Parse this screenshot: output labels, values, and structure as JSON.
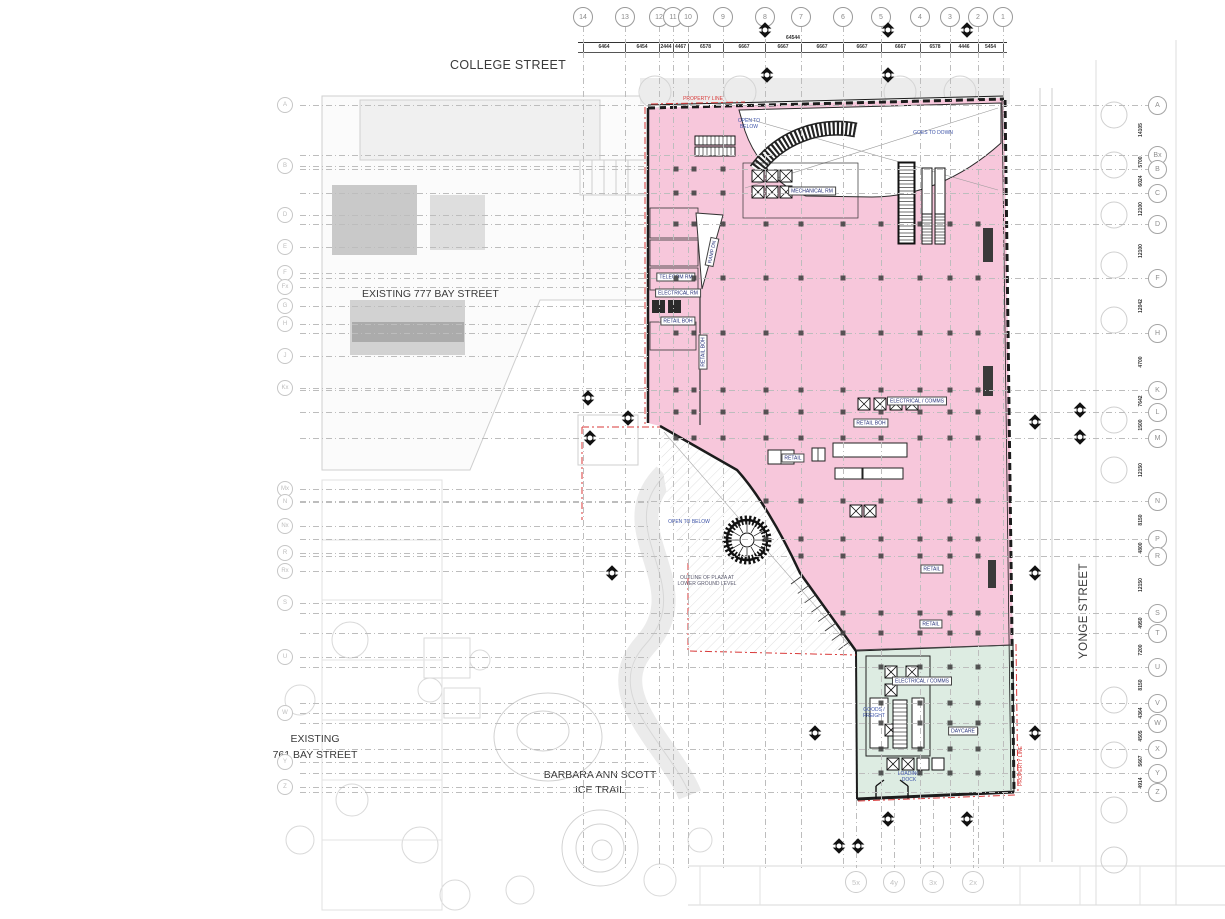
{
  "streets": {
    "college": "COLLEGE STREET",
    "yonge": "YONGE STREET",
    "bay777": "EXISTING 777 BAY STREET",
    "bay761": "EXISTING\n761 BAY STREET",
    "ice_trail": "BARBARA ANN SCOTT\nICE TRAIL"
  },
  "colors": {
    "retail_fill": "#f7c7db",
    "daycare_fill": "#ddece2",
    "property_line": "#d93a3a",
    "note_blue": "#3d53a8",
    "grid_line": "#bdbdbd",
    "wall": "#1c1c1c",
    "underlay": "#d2d2d2"
  },
  "grid": {
    "top": [
      {
        "label": "14",
        "x": 583
      },
      {
        "label": "13",
        "x": 625
      },
      {
        "label": "12",
        "x": 659
      },
      {
        "label": "11",
        "x": 673
      },
      {
        "label": "10",
        "x": 688
      },
      {
        "label": "9",
        "x": 723
      },
      {
        "label": "8",
        "x": 765
      },
      {
        "label": "7",
        "x": 801
      },
      {
        "label": "6",
        "x": 843
      },
      {
        "label": "5",
        "x": 881
      },
      {
        "label": "4",
        "x": 920
      },
      {
        "label": "3",
        "x": 950
      },
      {
        "label": "2",
        "x": 978
      },
      {
        "label": "1",
        "x": 1003
      }
    ],
    "left": [
      {
        "label": "A",
        "y": 105
      },
      {
        "label": "B",
        "y": 166
      },
      {
        "label": "D",
        "y": 215
      },
      {
        "label": "E",
        "y": 247
      },
      {
        "label": "F",
        "y": 273
      },
      {
        "label": "Fx",
        "y": 287
      },
      {
        "label": "G",
        "y": 306
      },
      {
        "label": "H",
        "y": 324
      },
      {
        "label": "J",
        "y": 356
      },
      {
        "label": "Kx",
        "y": 388
      },
      {
        "label": "Mx",
        "y": 489
      },
      {
        "label": "N",
        "y": 502
      },
      {
        "label": "Nx",
        "y": 526
      },
      {
        "label": "R",
        "y": 553
      },
      {
        "label": "Rx",
        "y": 571
      },
      {
        "label": "S",
        "y": 603
      },
      {
        "label": "U",
        "y": 657
      },
      {
        "label": "W",
        "y": 713
      },
      {
        "label": "Y",
        "y": 762
      },
      {
        "label": "Z",
        "y": 787
      }
    ],
    "right": [
      {
        "label": "A",
        "y": 105
      },
      {
        "label": "Bx",
        "y": 155
      },
      {
        "label": "B",
        "y": 169
      },
      {
        "label": "C",
        "y": 193
      },
      {
        "label": "D",
        "y": 224
      },
      {
        "label": "F",
        "y": 278
      },
      {
        "label": "H",
        "y": 333
      },
      {
        "label": "K",
        "y": 390
      },
      {
        "label": "L",
        "y": 412
      },
      {
        "label": "M",
        "y": 438
      },
      {
        "label": "N",
        "y": 501
      },
      {
        "label": "P",
        "y": 539
      },
      {
        "label": "R",
        "y": 556
      },
      {
        "label": "S",
        "y": 613
      },
      {
        "label": "T",
        "y": 633
      },
      {
        "label": "U",
        "y": 667
      },
      {
        "label": "V",
        "y": 703
      },
      {
        "label": "W",
        "y": 723
      },
      {
        "label": "X",
        "y": 749
      },
      {
        "label": "Y",
        "y": 773
      },
      {
        "label": "Z",
        "y": 792
      }
    ],
    "bottom": [
      {
        "label": "5x",
        "x": 856
      },
      {
        "label": "4y",
        "x": 894
      },
      {
        "label": "3x",
        "x": 933
      },
      {
        "label": "2x",
        "x": 973
      }
    ]
  },
  "dimensions": {
    "overall_top": "64544",
    "top_segments": [
      "6464",
      "6454",
      "2444",
      "4467",
      "6578",
      "6667",
      "6667",
      "6667",
      "6667",
      "6667",
      "6578",
      "4446",
      "5454"
    ],
    "right_segments": [
      "14105",
      "5700",
      "6024",
      "12100",
      "12100",
      "12042",
      "4700",
      "7642",
      "1500",
      "12150",
      "8150",
      "4800",
      "12150",
      "4950",
      "7200",
      "8150",
      "4364",
      "4505",
      "5667",
      "4914"
    ]
  },
  "rooms": [
    {
      "name": "MECHANICAL RM",
      "x": 812,
      "y": 191,
      "rot": 0
    },
    {
      "name": "TELECOM RM",
      "x": 676,
      "y": 277,
      "rot": 0
    },
    {
      "name": "ELECTRICAL RM",
      "x": 678,
      "y": 293,
      "rot": 0
    },
    {
      "name": "RETAIL BOH",
      "x": 678,
      "y": 321,
      "rot": 0
    },
    {
      "name": "RETAIL BOH",
      "x": 703,
      "y": 352,
      "rot": -90
    },
    {
      "name": "RAMP DN",
      "x": 712,
      "y": 252,
      "rot": -78
    },
    {
      "name": "ELECTRICAL / COMMS",
      "x": 917,
      "y": 401,
      "rot": 0
    },
    {
      "name": "RETAIL BOH",
      "x": 871,
      "y": 423,
      "rot": 0
    },
    {
      "name": "RETAIL",
      "x": 793,
      "y": 458,
      "rot": 0
    },
    {
      "name": "RETAIL",
      "x": 932,
      "y": 569,
      "rot": 0
    },
    {
      "name": "RETAIL",
      "x": 931,
      "y": 624,
      "rot": 0
    },
    {
      "name": "ELECTRICAL / COMMS",
      "x": 922,
      "y": 681,
      "rot": 0
    },
    {
      "name": "DAYCARE",
      "x": 963,
      "y": 731,
      "rot": 0
    }
  ],
  "notes": [
    {
      "text": "PROPERTY LINE",
      "x": 703,
      "y": 99,
      "color": "red",
      "rot": 0
    },
    {
      "text": "OPEN TO\nBELOW",
      "x": 749,
      "y": 124,
      "color": "blue",
      "rot": 0
    },
    {
      "text": "GOES TO DOWN",
      "x": 933,
      "y": 133,
      "color": "blue",
      "rot": 0
    },
    {
      "text": "OPEN TO BELOW",
      "x": 689,
      "y": 522,
      "color": "blue",
      "rot": 0
    },
    {
      "text": "OUTLINE OF PLAZA AT\nLOWER GROUND LEVEL",
      "x": 707,
      "y": 581,
      "color": "gray",
      "rot": 0
    },
    {
      "text": "GOODS /\nFREIGHT",
      "x": 874,
      "y": 713,
      "color": "blue",
      "rot": 0
    },
    {
      "text": "LOADING\nDOCK",
      "x": 909,
      "y": 777,
      "color": "blue",
      "rot": 0
    },
    {
      "text": "PROPERTY LINE",
      "x": 1021,
      "y": 766,
      "color": "red",
      "rot": -90
    }
  ],
  "section_markers": [
    {
      "x": 765,
      "y": 30
    },
    {
      "x": 888,
      "y": 30
    },
    {
      "x": 967,
      "y": 30
    },
    {
      "x": 767,
      "y": 75
    },
    {
      "x": 888,
      "y": 75
    },
    {
      "x": 588,
      "y": 398
    },
    {
      "x": 628,
      "y": 418
    },
    {
      "x": 590,
      "y": 438
    },
    {
      "x": 612,
      "y": 573
    },
    {
      "x": 1035,
      "y": 422
    },
    {
      "x": 1080,
      "y": 410
    },
    {
      "x": 1080,
      "y": 437
    },
    {
      "x": 1035,
      "y": 573
    },
    {
      "x": 1035,
      "y": 733
    },
    {
      "x": 815,
      "y": 733
    },
    {
      "x": 888,
      "y": 819
    },
    {
      "x": 967,
      "y": 819
    },
    {
      "x": 839,
      "y": 846
    },
    {
      "x": 858,
      "y": 846
    }
  ]
}
